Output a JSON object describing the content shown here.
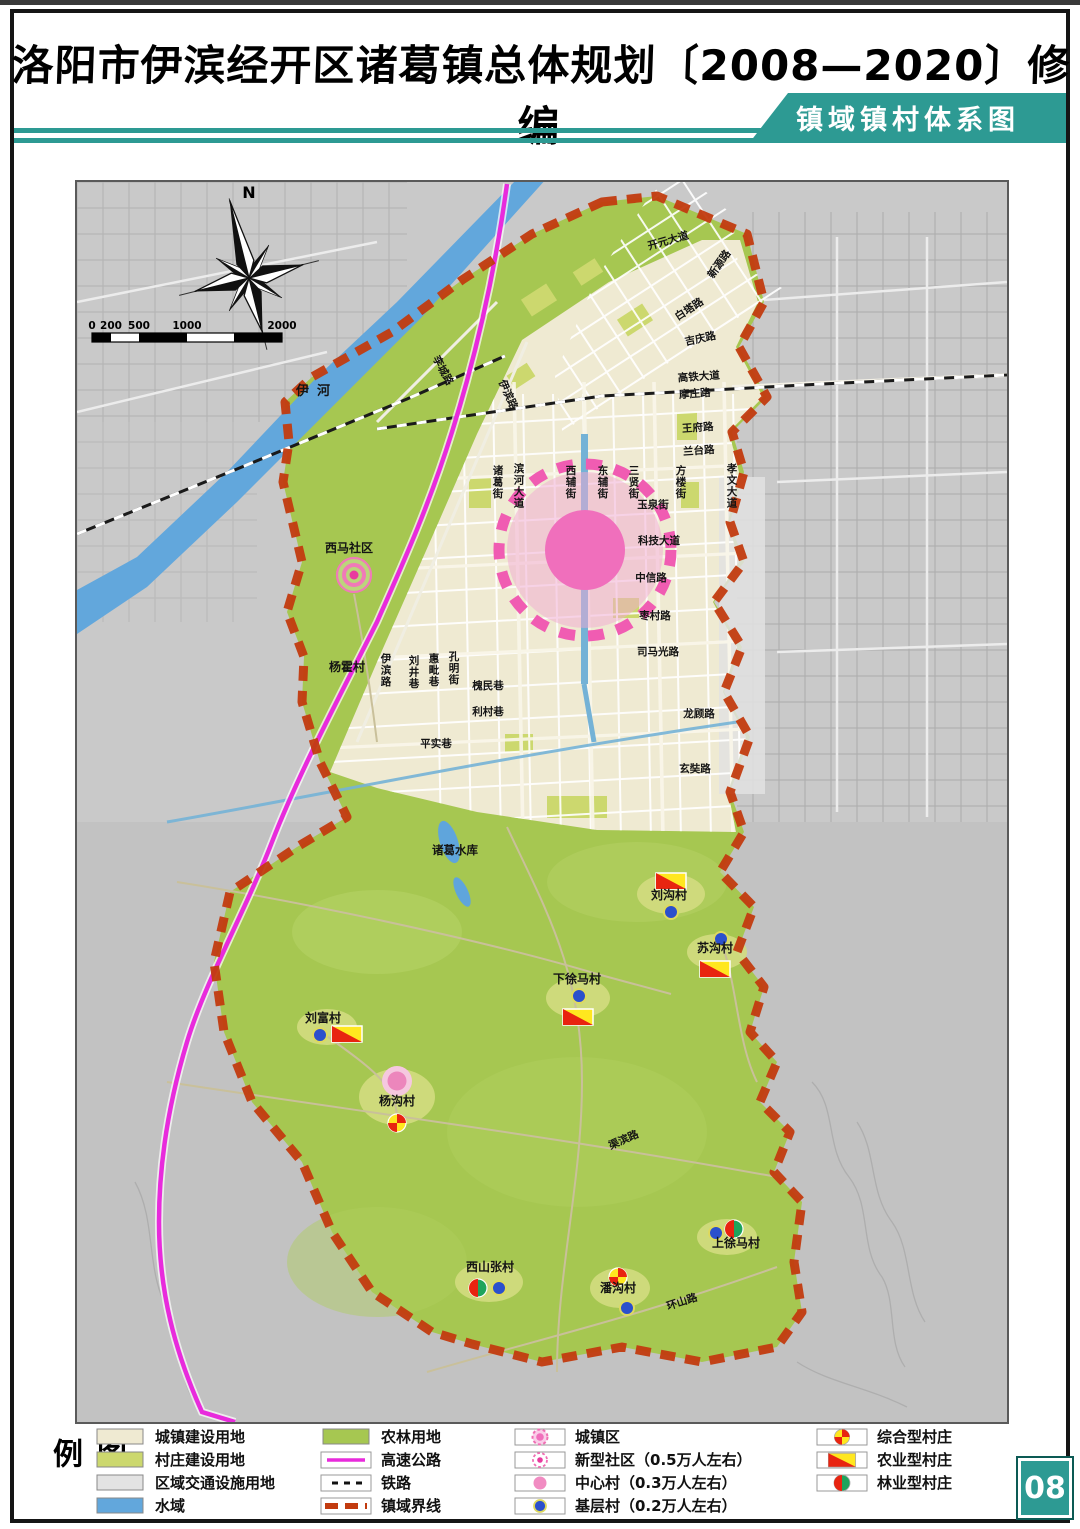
{
  "title": "洛阳市伊滨经开区诸葛镇总体规划〔2008—2020〕修编",
  "banner": "镇域镇村体系图",
  "page_number": "08",
  "legend_heading": "图例",
  "north_label": "N",
  "scale_ticks": [
    "0",
    "200",
    "500",
    "1000",
    "2000"
  ],
  "colors": {
    "teal": "#2d9a93",
    "boundary_red": "#c23b0f",
    "highway_magenta": "#e82bdc",
    "town_pink": "#f06fbc",
    "farm_green": "#a6c751",
    "village_green": "#ccd86e",
    "urban_beige": "#efead2",
    "water_blue": "#62a7dc",
    "transport_gray": "#e3e3e3",
    "dot_blue": "#2b50cc",
    "flag_yellow": "#ffe71f",
    "flag_red": "#e82410",
    "forest_green": "#1ea45c"
  },
  "map": {
    "labels": [
      {
        "t": "伊河",
        "x": 240,
        "y": 213,
        "s": 13,
        "ls": 8
      },
      {
        "t": "李城路",
        "x": 363,
        "y": 190,
        "r": 62
      },
      {
        "t": "伊滨路",
        "x": 428,
        "y": 214,
        "r": 66
      },
      {
        "t": "开元大道",
        "x": 592,
        "y": 62,
        "r": -16
      },
      {
        "t": "新源路",
        "x": 645,
        "y": 84,
        "r": -55
      },
      {
        "t": "白塔路",
        "x": 614,
        "y": 130,
        "r": -33
      },
      {
        "t": "吉庆路",
        "x": 624,
        "y": 160,
        "r": -12
      },
      {
        "t": "高铁大道",
        "x": 622,
        "y": 198,
        "r": -4
      },
      {
        "t": "摩庄路",
        "x": 618,
        "y": 215,
        "r": -4
      },
      {
        "t": "王府路",
        "x": 621,
        "y": 249,
        "r": -4
      },
      {
        "t": "兰台路",
        "x": 622,
        "y": 272,
        "r": -4
      },
      {
        "t": "玉泉街",
        "x": 576,
        "y": 326
      },
      {
        "t": "科技大道",
        "x": 582,
        "y": 362
      },
      {
        "t": "中信路",
        "x": 574,
        "y": 399
      },
      {
        "t": "枣村路",
        "x": 578,
        "y": 437
      },
      {
        "t": "司马光路",
        "x": 581,
        "y": 473
      },
      {
        "t": "龙顾路",
        "x": 622,
        "y": 535
      },
      {
        "t": "玄奘路",
        "x": 618,
        "y": 590
      },
      {
        "t": "槐民巷",
        "x": 411,
        "y": 507
      },
      {
        "t": "利村巷",
        "x": 411,
        "y": 533
      },
      {
        "t": "平实巷",
        "x": 359,
        "y": 565
      },
      {
        "t": "诸葛街",
        "x": 421,
        "y": 292,
        "v": 1
      },
      {
        "t": "滨河大道",
        "x": 442,
        "y": 290,
        "v": 1
      },
      {
        "t": "西辅街",
        "x": 494,
        "y": 292,
        "v": 1
      },
      {
        "t": "东辅街",
        "x": 526,
        "y": 292,
        "v": 1
      },
      {
        "t": "三贤街",
        "x": 557,
        "y": 292,
        "v": 1
      },
      {
        "t": "方楼街",
        "x": 604,
        "y": 292,
        "v": 1
      },
      {
        "t": "孝文大道",
        "x": 655,
        "y": 290,
        "v": 1
      },
      {
        "t": "伊滨路",
        "x": 309,
        "y": 480,
        "v": 1
      },
      {
        "t": "刘井巷",
        "x": 337,
        "y": 482,
        "v": 1
      },
      {
        "t": "惠毗巷",
        "x": 357,
        "y": 480,
        "v": 1
      },
      {
        "t": "孔明街",
        "x": 377,
        "y": 478,
        "v": 1
      },
      {
        "t": "诸葛水库",
        "x": 378,
        "y": 672,
        "s": 11.5
      },
      {
        "t": "渠滨路",
        "x": 548,
        "y": 961,
        "r": -24
      },
      {
        "t": "环山路",
        "x": 606,
        "y": 1123,
        "r": -18
      },
      {
        "t": "西马社区",
        "x": 272,
        "y": 370,
        "b": 1,
        "s": 12
      },
      {
        "t": "杨霍村",
        "x": 270,
        "y": 489,
        "b": 1,
        "s": 12
      },
      {
        "t": "刘沟村",
        "x": 592,
        "y": 717,
        "b": 1,
        "s": 12
      },
      {
        "t": "苏沟村",
        "x": 638,
        "y": 770,
        "b": 1,
        "s": 12
      },
      {
        "t": "下徐马村",
        "x": 500,
        "y": 801,
        "b": 1,
        "s": 12
      },
      {
        "t": "刘富村",
        "x": 246,
        "y": 840,
        "b": 1,
        "s": 12
      },
      {
        "t": "杨沟村",
        "x": 320,
        "y": 923,
        "b": 1,
        "s": 12
      },
      {
        "t": "西山张村",
        "x": 413,
        "y": 1089,
        "b": 1,
        "s": 12
      },
      {
        "t": "潘沟村",
        "x": 541,
        "y": 1110,
        "b": 1,
        "s": 12
      },
      {
        "t": "上徐马村",
        "x": 659,
        "y": 1065,
        "b": 1,
        "s": 12
      }
    ],
    "markers": [
      {
        "k": "town",
        "x": 508,
        "y": 368
      },
      {
        "k": "community",
        "x": 277,
        "y": 393
      },
      {
        "k": "flag",
        "x": 594,
        "y": 699
      },
      {
        "k": "dot",
        "x": 594,
        "y": 730
      },
      {
        "k": "dot",
        "x": 644,
        "y": 757
      },
      {
        "k": "flag",
        "x": 638,
        "y": 787
      },
      {
        "k": "dot",
        "x": 502,
        "y": 814
      },
      {
        "k": "flag",
        "x": 501,
        "y": 835
      },
      {
        "k": "dot",
        "x": 243,
        "y": 853
      },
      {
        "k": "flag",
        "x": 270,
        "y": 852
      },
      {
        "k": "pinkdot",
        "x": 320,
        "y": 899
      },
      {
        "k": "pie-ry",
        "x": 320,
        "y": 941
      },
      {
        "k": "pie-rg",
        "x": 401,
        "y": 1106
      },
      {
        "k": "dot",
        "x": 422,
        "y": 1106
      },
      {
        "k": "pie-ry",
        "x": 541,
        "y": 1095
      },
      {
        "k": "dot",
        "x": 550,
        "y": 1126
      },
      {
        "k": "dot",
        "x": 639,
        "y": 1051
      },
      {
        "k": "pie-rg",
        "x": 657,
        "y": 1047
      }
    ]
  },
  "legend": {
    "columns": [
      [
        {
          "s": "swatch-urban",
          "l": "城镇建设用地"
        },
        {
          "s": "swatch-village",
          "l": "村庄建设用地"
        },
        {
          "s": "swatch-transport",
          "l": "区域交通设施用地"
        },
        {
          "s": "swatch-water",
          "l": "水域"
        }
      ],
      [
        {
          "s": "swatch-farm",
          "l": "农林用地"
        },
        {
          "s": "line-highway",
          "l": "高速公路"
        },
        {
          "s": "line-railway",
          "l": "铁路"
        },
        {
          "s": "line-boundary",
          "l": "镇域界线"
        }
      ],
      [
        {
          "s": "sym-town",
          "l": "城镇区"
        },
        {
          "s": "sym-community",
          "l": "新型社区（0.5万人左右）"
        },
        {
          "s": "sym-central",
          "l": "中心村（0.3万人左右）"
        },
        {
          "s": "sym-basic",
          "l": "基层村（0.2万人左右）"
        }
      ],
      [
        {
          "s": "pie-ry",
          "l": "综合型村庄"
        },
        {
          "s": "flag",
          "l": "农业型村庄"
        },
        {
          "s": "pie-rg",
          "l": "林业型村庄"
        }
      ]
    ]
  }
}
